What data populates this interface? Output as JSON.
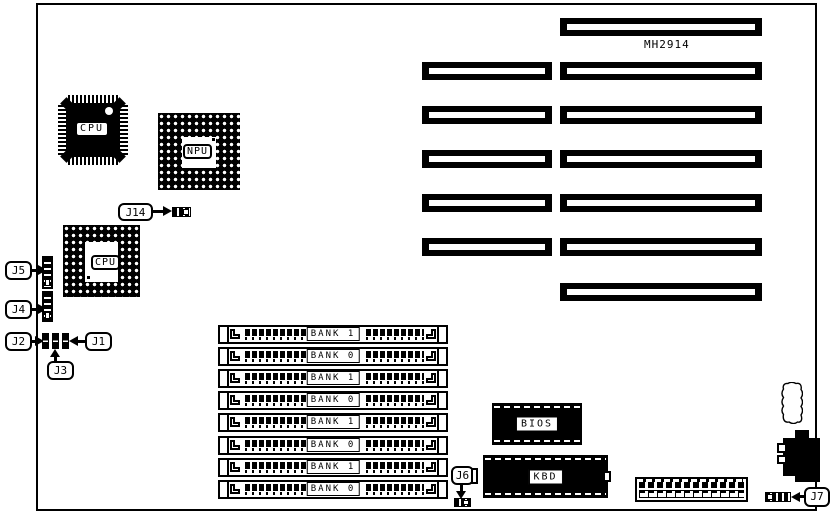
{
  "board": {
    "model_label": "MH2914",
    "chips": {
      "cpu_qfp": "CPU",
      "npu": "NPU",
      "cpu_pga": "CPU",
      "bios": "BIOS",
      "kbd": "KBD"
    },
    "jumper_labels": {
      "j14": "J14",
      "j5": "J5",
      "j4": "J4",
      "j2": "J2",
      "j1": "J1",
      "j3": "J3",
      "j6": "J6",
      "j7": "J7"
    },
    "memory_banks": [
      "BANK 1",
      "BANK 0",
      "BANK 1",
      "BANK 0",
      "BANK 1",
      "BANK 0",
      "BANK 1",
      "BANK 0"
    ],
    "expansion_slots": {
      "long_count": 7,
      "short_count": 5
    },
    "colors": {
      "ink": "#000000",
      "paper": "#ffffff"
    }
  }
}
